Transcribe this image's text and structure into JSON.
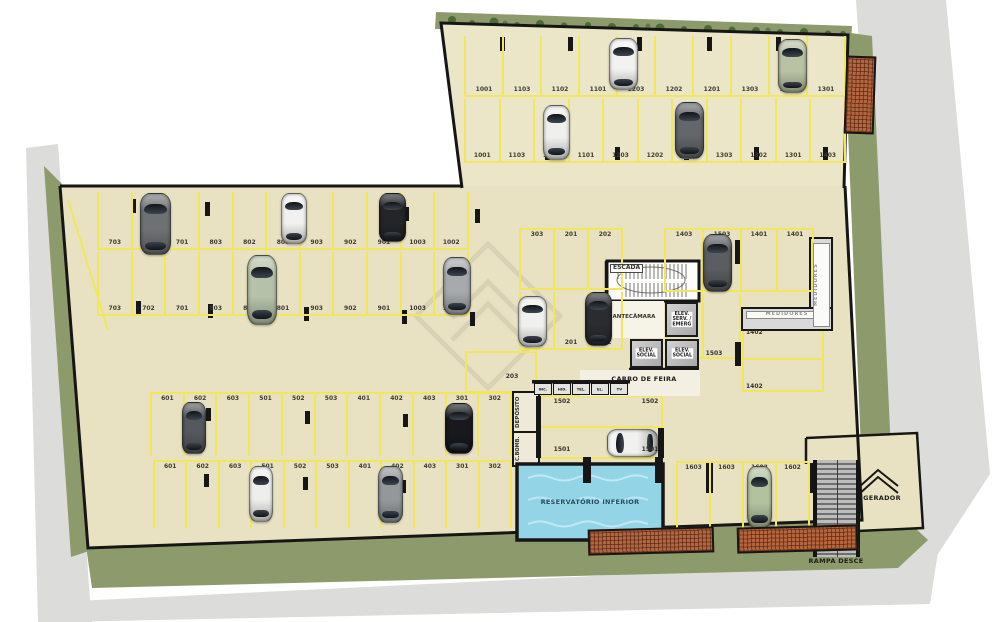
{
  "colors": {
    "floor": "#e9e2c2",
    "stall_line": "#f2e75c",
    "green_strip": "#8d9a6c",
    "tree_green": "#4c6a36",
    "sidewalk": "#dcdcda",
    "water": "#93d4e6",
    "brick": "#b4653e",
    "wall": "#161616"
  },
  "stall_rows": {
    "a1": [
      "1001",
      "1103",
      "1102",
      "1101",
      "1203",
      "1202",
      "1201",
      "1303",
      "1302",
      "1301"
    ],
    "a2": [
      "1001",
      "1103",
      "1102",
      "1101",
      "1203",
      "1202",
      "1201",
      "1303",
      "1302",
      "1301",
      "1403"
    ],
    "b1": [
      "703",
      "702",
      "701",
      "803",
      "802",
      "801",
      "903",
      "902",
      "901",
      "1003",
      "1002"
    ],
    "b2": [
      "703",
      "702",
      "701",
      "803",
      "802",
      "801",
      "903",
      "902",
      "901",
      "1003",
      "1002"
    ],
    "c1": [
      "601",
      "602",
      "603",
      "501",
      "502",
      "503",
      "401",
      "402",
      "403",
      "301",
      "302"
    ],
    "c2": [
      "601",
      "602",
      "603",
      "501",
      "502",
      "503",
      "401",
      "402",
      "403",
      "301",
      "302"
    ],
    "d1": [
      "303",
      "201",
      "202"
    ],
    "d2": [
      "303",
      "201",
      "202"
    ],
    "e1": [
      "1403",
      "1503"
    ],
    "f1": [
      "1401",
      "1401"
    ],
    "g1": [
      "1603",
      "1603",
      "1602",
      "1602"
    ]
  },
  "point_labels": {
    "p203": "203",
    "p1503": "1503",
    "p1402a": "1402",
    "p1402b": "1402",
    "p1502a": "1502",
    "p1502b": "1502",
    "p1501a": "1501",
    "p1501b": "1501"
  },
  "rooms": {
    "escada": "ESCADA",
    "antecamara": "ANTECÂMARA",
    "elev_serv": "ELEV.\nSERV. /\nEMERG",
    "elev_social": "ELEV.\nSOCIAL",
    "carro_de_feira": "CARRO DE FEIRA",
    "medidores": "MEDIDORES",
    "deposito": "DEPÓSITO",
    "c_bomb": "C.BOMB.",
    "reservatorio": "RESERVATÓRIO INFERIOR",
    "gerador": "GERADOR",
    "rampa": "RAMPA DESCE",
    "shafts": [
      "INC.",
      "HID.",
      "TEL.",
      "EL.",
      "TV"
    ]
  }
}
